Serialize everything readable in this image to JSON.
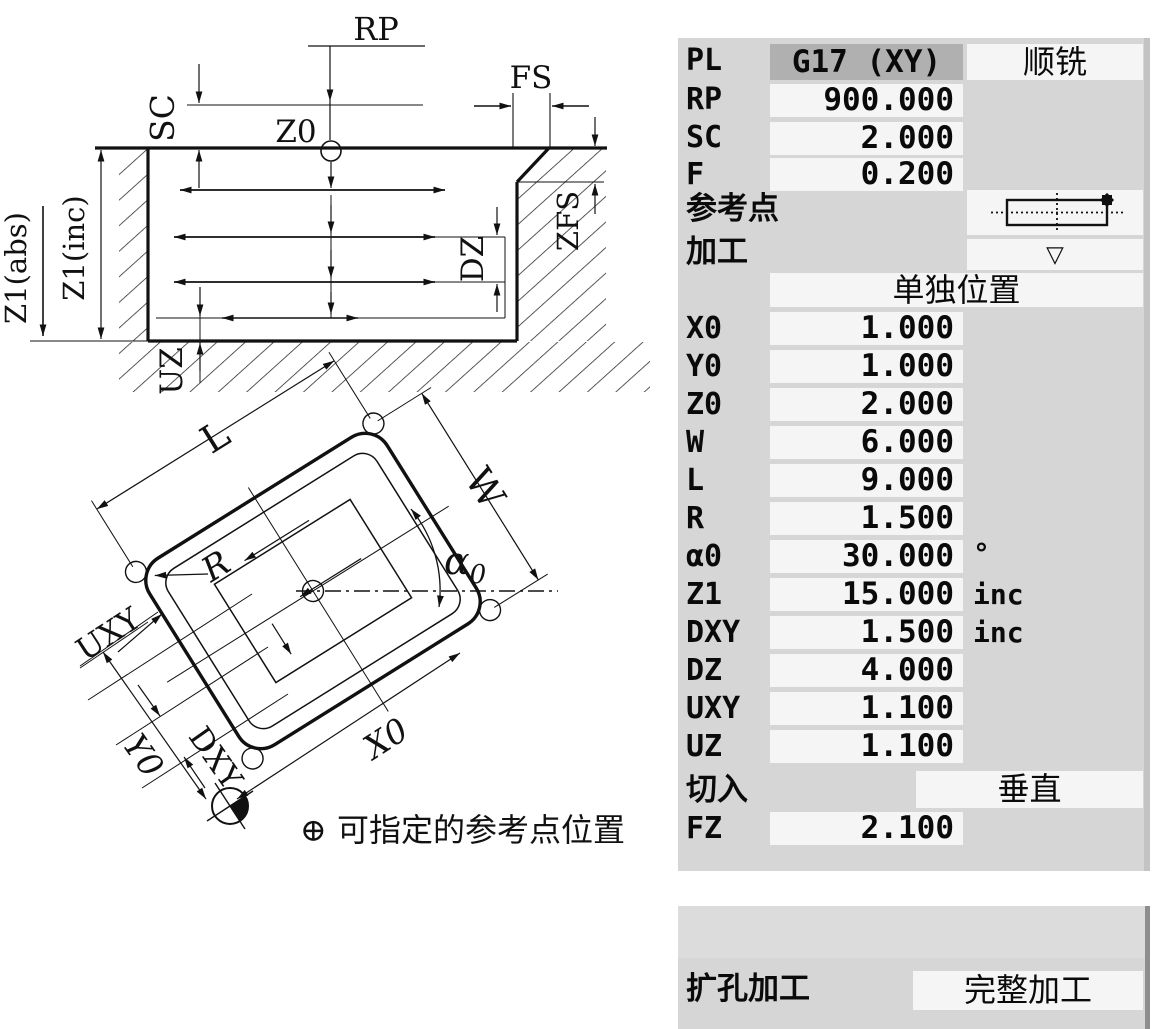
{
  "colors": {
    "panel_bg": "#d6d6d6",
    "field_bg": "#f5f5f5",
    "selected_field_bg": "#b0b0b0",
    "panel_edge": "#c3c3c3",
    "ink": "#111111"
  },
  "params": {
    "pl": {
      "label": "PL",
      "value": "G17 (XY)",
      "mode": "顺铣"
    },
    "rp": {
      "label": "RP",
      "value": "900.000"
    },
    "sc": {
      "label": "SC",
      "value": "2.000"
    },
    "f": {
      "label": "F",
      "value": "0.200"
    },
    "ref_point": {
      "label": "参考点"
    },
    "machining": {
      "label": "加工",
      "value": "▽"
    },
    "position_header": "单独位置",
    "x0": {
      "label": "X0",
      "value": "1.000"
    },
    "y0": {
      "label": "Y0",
      "value": "1.000"
    },
    "z0": {
      "label": "Z0",
      "value": "2.000"
    },
    "w": {
      "label": "W",
      "value": "6.000"
    },
    "l": {
      "label": "L",
      "value": "9.000"
    },
    "r": {
      "label": "R",
      "value": "1.500"
    },
    "alpha0": {
      "label": "α0",
      "value": "30.000",
      "unit": "°"
    },
    "z1": {
      "label": "Z1",
      "value": "15.000",
      "unit": "inc"
    },
    "dxy": {
      "label": "DXY",
      "value": "1.500",
      "unit": "inc"
    },
    "dz": {
      "label": "DZ",
      "value": "4.000"
    },
    "uxy": {
      "label": "UXY",
      "value": "1.100"
    },
    "uz": {
      "label": "UZ",
      "value": "1.100"
    },
    "plunge": {
      "label": "切入",
      "value": "垂直"
    },
    "fz": {
      "label": "FZ",
      "value": "2.100"
    }
  },
  "bottom_panel": {
    "label": "扩孔加工",
    "value": "完整加工"
  },
  "diagram": {
    "labels": {
      "rp": "RP",
      "fs": "FS",
      "sc": "SC",
      "z0": "Z0",
      "zfs": "ZFS",
      "dz": "DZ",
      "z1_abs": "Z1(abs)",
      "z1_inc": "Z1(inc)",
      "uz": "UZ",
      "l": "L",
      "w": "W",
      "r": "R",
      "alpha": "α",
      "alpha_sub": "0",
      "x0": "X0",
      "y0": "Y0",
      "dxy": "DXY",
      "uxy": "UXY",
      "legend": "⊕ 可指定的参考点位置"
    }
  }
}
